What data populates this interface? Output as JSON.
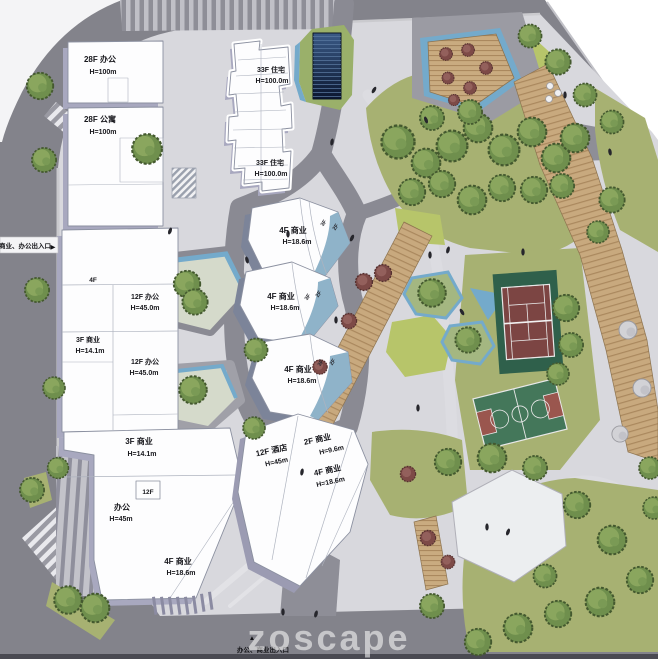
{
  "meta": {
    "type": "architectural-master-plan",
    "watermark": "zoscape"
  },
  "entrances": {
    "left": "商业、办公出入口",
    "left_arrow": "▶",
    "bottom": "办公、商业出入口",
    "bottom_arrow": "▲"
  },
  "buildings": [
    {
      "id": "office-28f",
      "l1": "28F 办公",
      "l2": "H=100m"
    },
    {
      "id": "apartment-28f",
      "l1": "28F 公寓",
      "l2": "H=100m"
    },
    {
      "id": "residential-33f-a",
      "l1": "33F 住宅",
      "l2": "H=100.0m"
    },
    {
      "id": "residential-33f-b",
      "l1": "33F 住宅",
      "l2": "H=100.0m"
    },
    {
      "id": "retail-4f-hex-a",
      "l1": "4F 商业",
      "l2": "H=18.6m"
    },
    {
      "id": "retail-4f-hex-b",
      "l1": "4F 商业",
      "l2": "H=18.6m"
    },
    {
      "id": "retail-4f-hex-c",
      "l1": "4F 商业",
      "l2": "H=18.6m"
    },
    {
      "id": "office-12f-a",
      "l1": "12F 办公",
      "l2": "H=45.0m"
    },
    {
      "id": "retail-3f-a",
      "l1": "3F 商业",
      "l2": "H=14.1m"
    },
    {
      "id": "office-12f-b",
      "l1": "12F 办公",
      "l2": "H=45.0m"
    },
    {
      "id": "retail-3f-b",
      "l1": "3F 商业",
      "l2": "H=14.1m"
    },
    {
      "id": "office-45m",
      "l1": "办公",
      "l2": "H=45m"
    },
    {
      "id": "hotel-12f",
      "l1": "12F 酒店",
      "l2": "H=45m"
    },
    {
      "id": "retail-2f",
      "l1": "2F 商业",
      "l2": "H=9.6m"
    },
    {
      "id": "retail-4f-hotel",
      "l1": "4F 商业",
      "l2": "H=18.6m"
    },
    {
      "id": "retail-4f-south",
      "l1": "4F 商业",
      "l2": "H=18.6m"
    }
  ],
  "tags": {
    "f4": "4F",
    "f12": "12F",
    "f3": "3F",
    "f2": "2F"
  },
  "colors": {
    "road_dark": "#83838b",
    "road_mid": "#9b9ba3",
    "plaza": "#d8d8dd",
    "building_white": "#fdfdfe",
    "building_shadow": "#a6a6bd",
    "hex_glass_blue": "#8fb3c9",
    "water_blue": "#74aacb",
    "lawn_olive": "#a7b172",
    "lawn_bright": "#b7c56a",
    "tree_green": "#7d9c55",
    "tree_maroon": "#7e4a47",
    "wood_deck": "#c8a97e",
    "tennis_green": "#2f604b",
    "court_maroon": "#7c4543",
    "basketball_green": "#44775a",
    "key_maroon": "#9a564e",
    "glass_tower": "#16243f"
  }
}
